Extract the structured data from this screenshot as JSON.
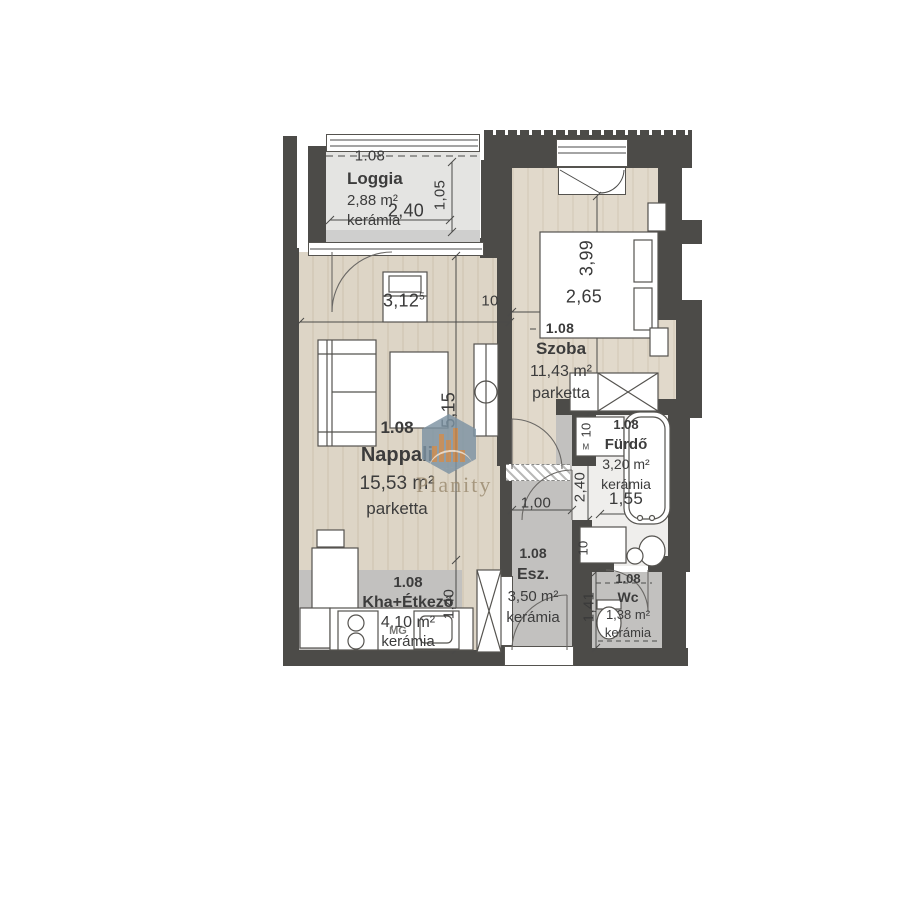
{
  "watermark": {
    "brand": "Planity"
  },
  "rooms": [
    {
      "id": "loggia",
      "level": "1.08",
      "name": "Loggia",
      "area": "2,88 m²",
      "floor": "kerámia"
    },
    {
      "id": "nappali",
      "level": "1.08",
      "name": "Nappali",
      "area": "15,53 m²",
      "floor": "parketta"
    },
    {
      "id": "szoba",
      "level": "1.08",
      "name": "Szoba",
      "area": "11,43 m²",
      "floor": "parketta"
    },
    {
      "id": "kha",
      "level": "1.08",
      "name": "Kha+Étkező",
      "area": "4,10 m²",
      "floor": "kerámia"
    },
    {
      "id": "esz",
      "level": "1.08",
      "name": "Esz.",
      "area": "3,50 m²",
      "floor": "kerámia"
    },
    {
      "id": "furdo",
      "level": "1.08",
      "name": "Fürdő",
      "area": "3,20 m²",
      "floor": "kerámia"
    },
    {
      "id": "wc",
      "level": "1.08",
      "name": "Wc",
      "area": "1,38 m²",
      "floor": "kerámia"
    }
  ],
  "dimensions": {
    "loggia_axis": "1.08",
    "loggia_width": "2,40",
    "loggia_depth": "1,05",
    "nappali_width": "3,12",
    "nappali_width_sup": "5",
    "nappali_height": "5,15",
    "wall_thickness": "10",
    "szoba_axis": "1.08",
    "szoba_width": "2,65",
    "szoba_height": "3,99",
    "esz_width": "1,00",
    "furdo_height": "2,40",
    "furdo_width": "1,55",
    "washer_width": "10",
    "washer_mark": "M",
    "niche_width": "10",
    "wc_height": "1,41",
    "kha_height": "1,40"
  },
  "appliances": {
    "dishwasher": "MG"
  },
  "colors": {
    "wall": "#4c4b48",
    "wood_floor": "#ddd5c6",
    "ceramic_floor": "#c2c1bf",
    "watermark_hex": "#7d93a3",
    "watermark_bars": "#c08148"
  }
}
